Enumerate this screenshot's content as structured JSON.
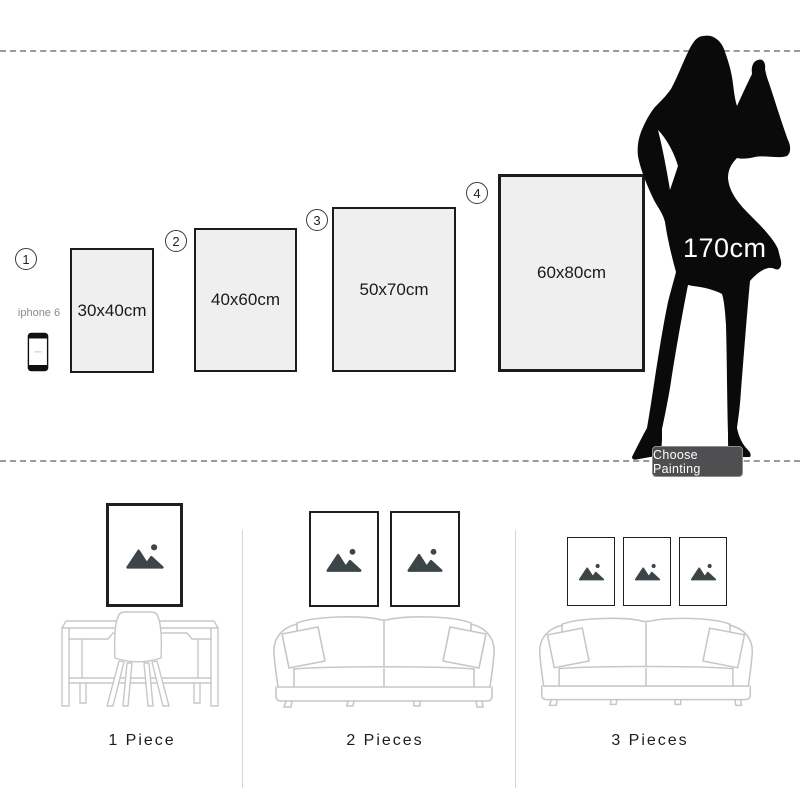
{
  "size_guide": {
    "options": [
      {
        "number": "1",
        "size": "30x40cm"
      },
      {
        "number": "2",
        "size": "40x60cm"
      },
      {
        "number": "3",
        "size": "50x70cm"
      },
      {
        "number": "4",
        "size": "60x80cm"
      }
    ],
    "phone_label": "iphone 6",
    "model_height": "170cm",
    "choose_button_label": "Choose Painting"
  },
  "room_previews": [
    {
      "label": "1 Piece",
      "frame_count": 1
    },
    {
      "label": "2 Pieces",
      "frame_count": 2
    },
    {
      "label": "3 Pieces",
      "frame_count": 3
    }
  ],
  "icons": {
    "frame_placeholder": "image-placeholder-icon",
    "phone": "iphone-icon",
    "model": "woman-silhouette"
  },
  "colors": {
    "panel_fill": "#efefef",
    "panel_border": "#1c1c1c",
    "silhouette": "#0a0a0a",
    "button_background": "#4f4f51",
    "button_text": "#ffffff",
    "furniture_outline": "#c7c7c7",
    "placeholder_icon": "#3d4549",
    "dashed_line": "#9a9a9a",
    "divider": "#d6d6d6"
  }
}
